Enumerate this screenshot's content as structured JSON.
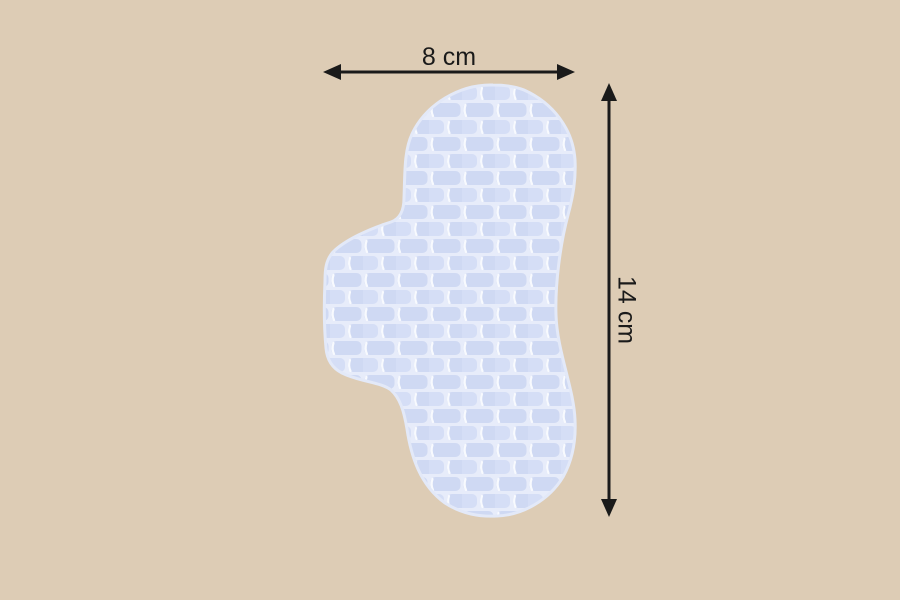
{
  "scene": {
    "description": "Product dimension diagram of a quilted absorbent pad with wing",
    "background_color": "#ddccb5"
  },
  "pad": {
    "name": "quilted-pad",
    "mortar_color": "#e7ecfa",
    "brick_color": "#cfd9f3",
    "brick_color_alt": "#d5def6",
    "highlight_color": "#f8fafe",
    "edge_color": "#e3e9f8"
  },
  "annotations": {
    "color": "#1a1a1a",
    "width": {
      "label": "8 cm"
    },
    "height": {
      "label": "14 cm"
    }
  }
}
